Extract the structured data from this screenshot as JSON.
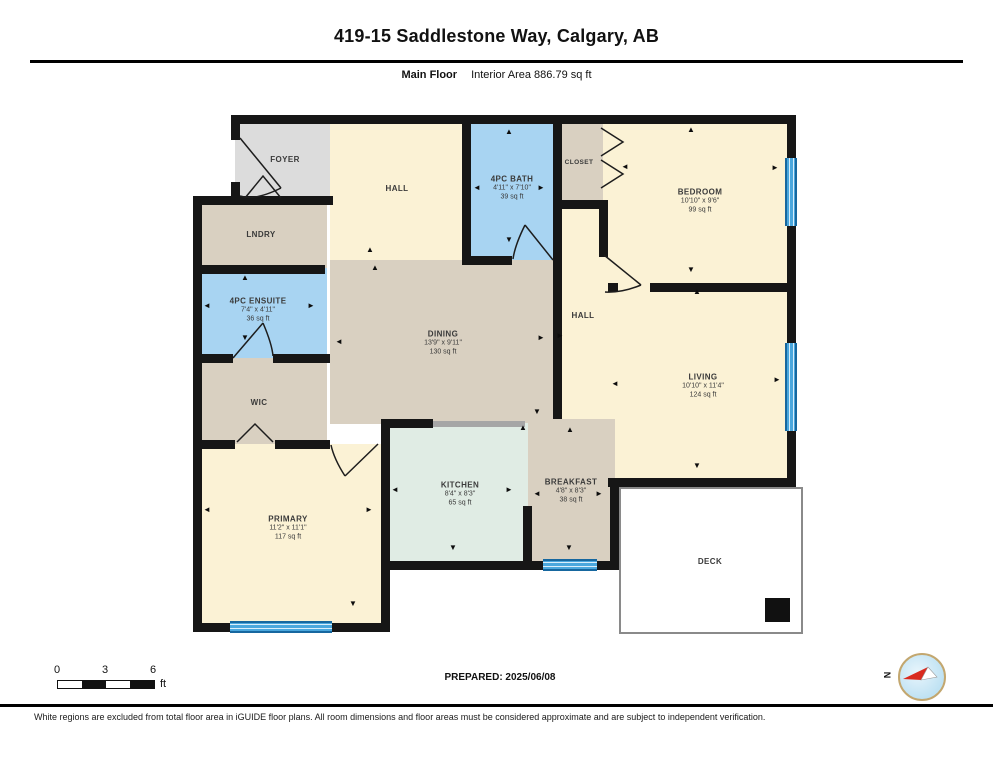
{
  "header": {
    "title": "419-15 Saddlestone Way, Calgary, AB",
    "floor_label": "Main Floor",
    "interior_area": "Interior Area 886.79 sq ft"
  },
  "rooms": {
    "foyer": {
      "name": "FOYER"
    },
    "hall_top": {
      "name": "HALL"
    },
    "bath": {
      "name": "4PC BATH",
      "dims": "4'11\" x 7'10\"",
      "area": "39 sq ft"
    },
    "closet": {
      "name": "CLOSET"
    },
    "bedroom": {
      "name": "BEDROOM",
      "dims": "10'10\" x 9'6\"",
      "area": "99 sq ft"
    },
    "lndry": {
      "name": "LNDRY"
    },
    "ensuite": {
      "name": "4PC ENSUITE",
      "dims": "7'4\" x 4'11\"",
      "area": "36 sq ft"
    },
    "wic": {
      "name": "WIC"
    },
    "dining": {
      "name": "DINING",
      "dims": "13'9\" x 9'11\"",
      "area": "130 sq ft"
    },
    "hall_mid": {
      "name": "HALL"
    },
    "living": {
      "name": "LIVING",
      "dims": "10'10\" x 11'4\"",
      "area": "124 sq ft"
    },
    "primary": {
      "name": "PRIMARY",
      "dims": "11'2\" x 11'1\"",
      "area": "117 sq ft"
    },
    "kitchen": {
      "name": "KITCHEN",
      "dims": "8'4\" x 8'3\"",
      "area": "65 sq ft"
    },
    "breakfast": {
      "name": "BREAKFAST",
      "dims": "4'8\" x 8'3\"",
      "area": "38 sq ft"
    },
    "deck": {
      "name": "DECK"
    }
  },
  "footer": {
    "scale": {
      "start": "0",
      "mid": "3",
      "end": "6",
      "unit": "ft"
    },
    "prepared": "PREPARED: 2025/06/08",
    "compass_label": "N",
    "disclaimer": "White regions are excluded from total floor area in iGUIDE floor plans. All room dimensions and floor areas must be considered approximate and are subject to independent verification."
  },
  "colors": {
    "wall": "#161616",
    "room_cream": "#fbf2d5",
    "room_tan": "#d9d0c1",
    "room_gray": "#dcdcdc",
    "room_blue": "#a8d4f2",
    "room_mint": "#e0ece4",
    "window_blue": "#4aa7dd",
    "compass_red": "#d92b1f"
  }
}
